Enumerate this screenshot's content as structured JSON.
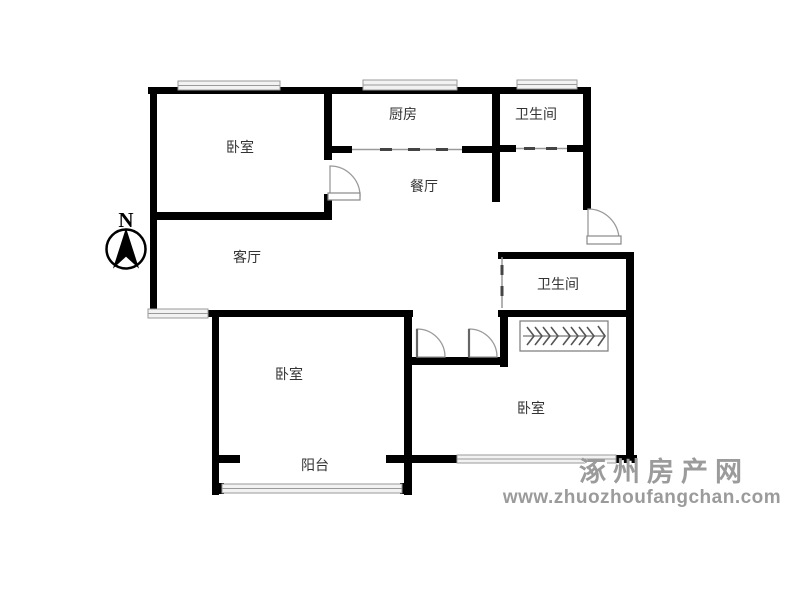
{
  "compass": {
    "label": "N"
  },
  "rooms": {
    "bedroom_nw": "卧室",
    "kitchen": "厨房",
    "bathroom_n": "卫生间",
    "dining": "餐厅",
    "living": "客厅",
    "bathroom_e": "卫生间",
    "bedroom_sw": "卧室",
    "balcony": "阳台",
    "bedroom_se": "卧室"
  },
  "watermark": {
    "name": "涿州房产网",
    "url": "www.zhuozhoufangchan.com"
  },
  "colors": {
    "wall": "#000000",
    "window_line": "#b0b0b0",
    "window_edge": "#9a9a9a",
    "door_line": "#9a9a9a",
    "door_panel_edge": "#666666",
    "slide_line": "#999999",
    "slide_tick": "#444444",
    "closet_line": "#787878",
    "closet_tick": "#555555",
    "label_text": "#333333",
    "watermark": "#9b9b9b",
    "watermark_shadow": "#ffffff"
  }
}
